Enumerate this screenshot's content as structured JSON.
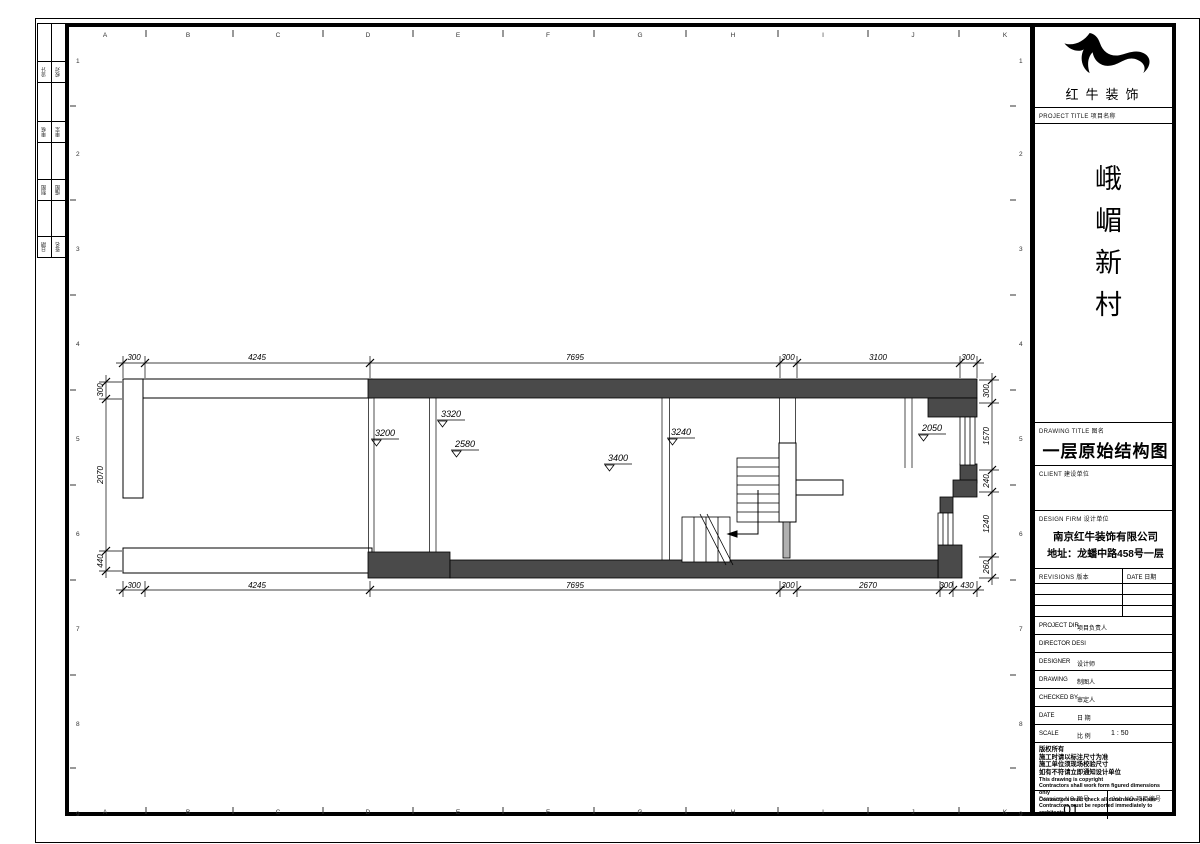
{
  "sheet": {
    "grid_letters": [
      "A",
      "B",
      "C",
      "D",
      "E",
      "F",
      "G",
      "H",
      "I",
      "J",
      "K"
    ],
    "grid_numbers": [
      "1",
      "2",
      "3",
      "4",
      "5",
      "6",
      "7",
      "8",
      "9"
    ]
  },
  "signature_table": {
    "rows": [
      {
        "a": "设计",
        "b": "校对"
      },
      {
        "a": "审核",
        "b": "审定"
      },
      {
        "a": "制图",
        "b": "描图"
      },
      {
        "a": "日期",
        "b": "签名"
      }
    ]
  },
  "title_block": {
    "company_name": "红牛装饰",
    "project_title_label": "PROJECT TITLE  项目名称",
    "project_name": "峨嵋新村",
    "drawing_title_label": "DRAWING TITLE  图名",
    "drawing_title": "一层原始结构图",
    "client_label": "CLIENT  建设单位",
    "design_firm_label": "DESIGN FIRM  设计单位",
    "design_firm_name": "南京红牛装饰有限公司",
    "design_firm_address": "地址：龙蟠中路458号一层",
    "revisions_label": "REVISIONS  版本",
    "date_label": "DATE  日期",
    "rows": [
      {
        "en": "PROJECT DIR",
        "zh": "项目负责人"
      },
      {
        "en": "DIRECTOR DESI",
        "zh": ""
      },
      {
        "en": "DESIGNER",
        "zh": "设计师"
      },
      {
        "en": "DRAWING",
        "zh": "制图人"
      },
      {
        "en": "CHECKED BY",
        "zh": "审定人"
      },
      {
        "en": "DATE",
        "zh": "日 期"
      },
      {
        "en": "SCALE",
        "zh": "比 例",
        "value": "1 : 50"
      }
    ],
    "copyright_lines": [
      "版权所有",
      "施工时请以标注尺寸为准",
      "施工单位须现场校验尺寸",
      "如有不符请立即通知设计单位",
      "This drawing is copyright",
      "Contractors shall work form figured dimensions only",
      "Contractors must check all dimensions on site",
      "Contractors must be reported immediately to architects"
    ],
    "drawing_no_label": "Drawing NO  图号",
    "drawing_no": "01",
    "job_no_label": "Job NO  项目编号"
  },
  "plan": {
    "dims_top": [
      "300",
      "4245",
      "7695",
      "300",
      "3100",
      "300"
    ],
    "dims_bottom": [
      "300",
      "4245",
      "7695",
      "300",
      "2670",
      "300",
      "430"
    ],
    "dims_left": [
      "300",
      "2070",
      "440"
    ],
    "dims_right": [
      "300",
      "1570",
      "240",
      "1240",
      "260"
    ],
    "levels": [
      "3200",
      "3320",
      "2580",
      "3400",
      "3240",
      "2050"
    ]
  }
}
